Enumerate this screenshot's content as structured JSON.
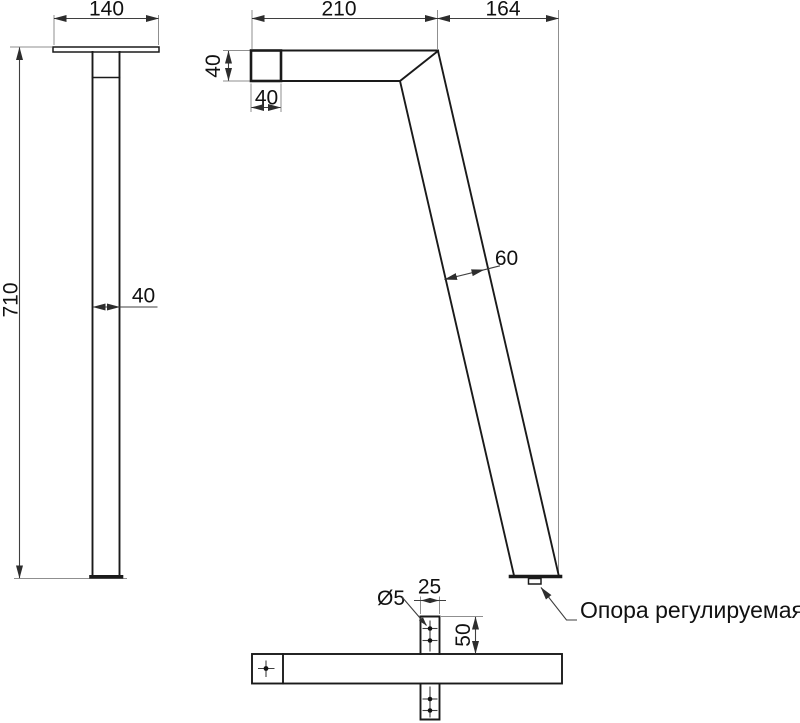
{
  "front_view": {
    "plate_width": "140",
    "leg_height": "710",
    "leg_width": "40"
  },
  "side_view": {
    "arm_length": "210",
    "foot_offset": "164",
    "section_height": "40",
    "section_width": "40",
    "leg_width": "60",
    "foot_callout": "Опора регулируемая"
  },
  "plan_view": {
    "hole_diameter": "Ø5",
    "tab_width": "25",
    "tab_height": "50"
  },
  "colors": {
    "ink": "#1a1a1a",
    "dimension": "#3f3f3f",
    "extension": "#8f8f8f",
    "background": "#ffffff"
  }
}
